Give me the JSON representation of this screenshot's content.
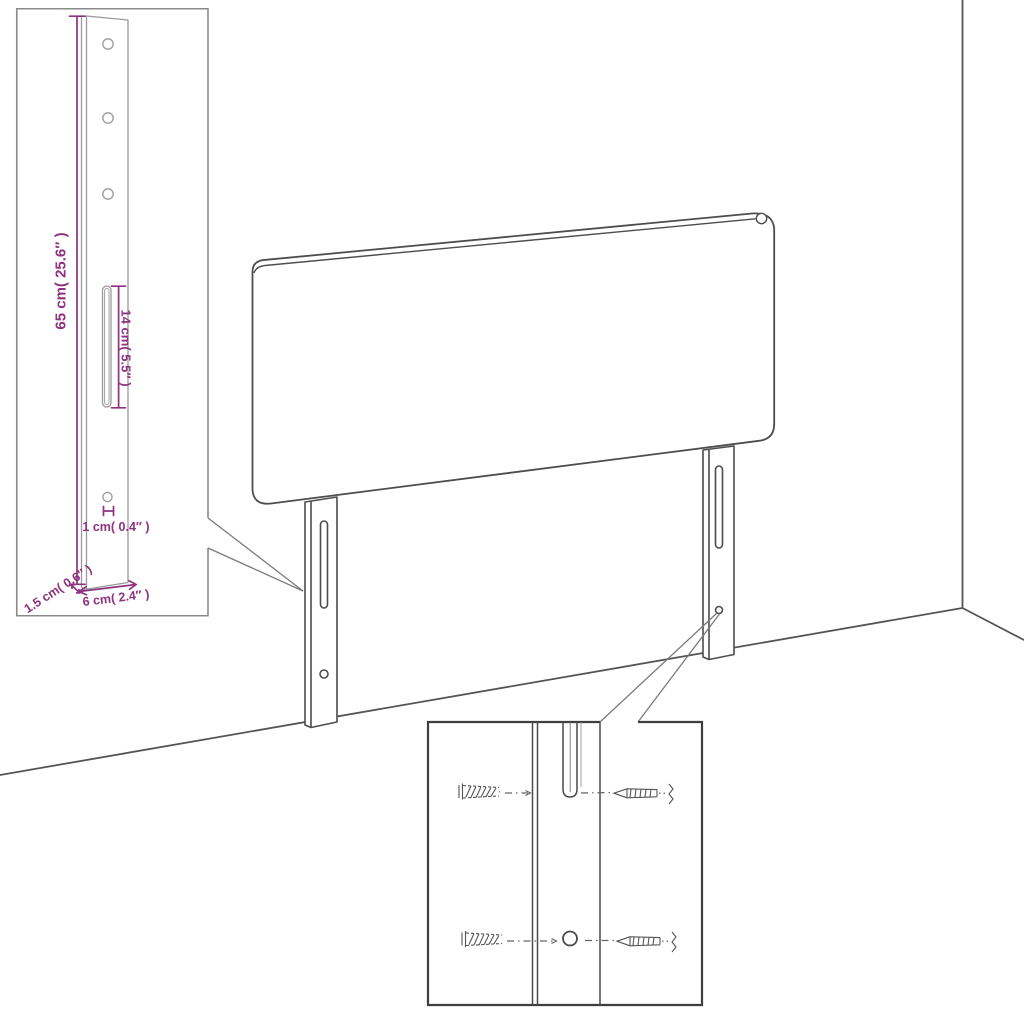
{
  "page": {
    "background": "#ffffff"
  },
  "colors": {
    "dimension_accent": "#8d3380",
    "line_art": "#4d4d4d",
    "inset_border": "#8a8a8a",
    "detail_box_border": "#3f3f3f"
  },
  "scene": {
    "description_parts": [
      "headboard-panel",
      "mounting-leg-left",
      "mounting-leg-right",
      "wall-corner"
    ],
    "icons": [
      "wall-plug-icon",
      "screw-icon"
    ]
  },
  "insets": {
    "leg_detail": {
      "dimensions": {
        "height": "65 cm( 25.6″ )",
        "slot_length": "14 cm( 5.5″ )",
        "hole_diameter": "1 cm( 0.4″ )",
        "thickness": "1.5 cm( 0.6″ )",
        "width": "6 cm( 2.4″ )"
      }
    },
    "mounting_detail": {
      "parts": [
        "wall-plug",
        "screw"
      ]
    }
  }
}
